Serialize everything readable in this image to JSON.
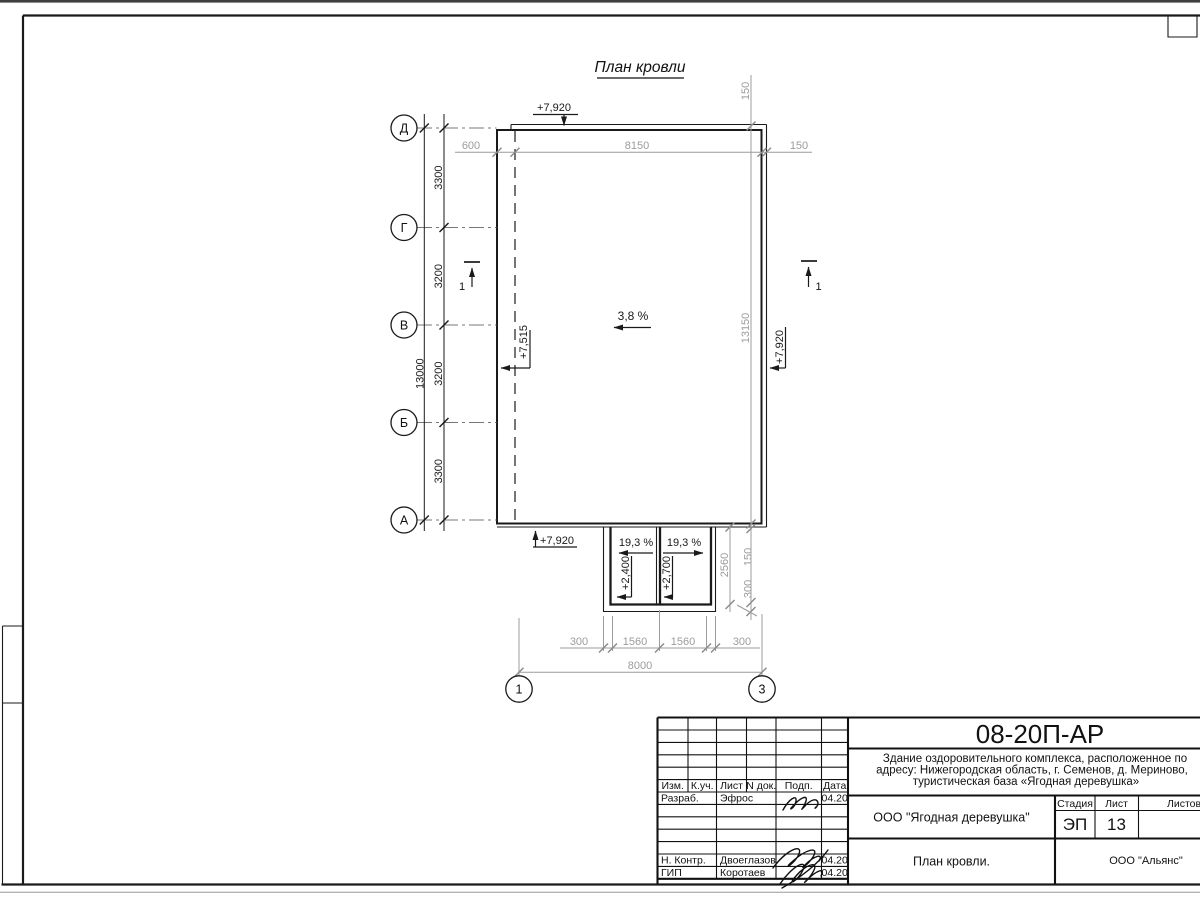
{
  "sheet": {
    "title": "План кровли"
  },
  "axes": {
    "rows": [
      "Д",
      "Г",
      "В",
      "Б",
      "А"
    ],
    "cols": [
      "1",
      "3"
    ]
  },
  "dims": {
    "top": [
      "600",
      "8150",
      "150"
    ],
    "left_segments": [
      "3300",
      "3200",
      "3200",
      "3300"
    ],
    "left_total": "13000",
    "right_top": "150",
    "right_total": "13150",
    "canopy_height": "2560",
    "canopy_right_150": "150",
    "canopy_right_300": "300",
    "bottom": [
      "300",
      "1560",
      "1560",
      "300"
    ],
    "bottom_total": "8000"
  },
  "marks": {
    "elev_top": "+7,920",
    "elev_left": "+7,515",
    "elev_right": "+7,920",
    "elev_bottom": "+7,920",
    "canopy_elev_left": "+2,400",
    "canopy_elev_right": "+2,700",
    "slope_main": "3,8 %",
    "canopy_slope_left": "19,3 %",
    "canopy_slope_right": "19,3 %",
    "section_left": "1",
    "section_right": "1"
  },
  "titleblock": {
    "doc_number": "08-20П-АР",
    "project_line1": "Здание оздоровительного комплекса, расположенное по",
    "project_line2": "адресу: Нижегородская область, г. Семенов, д. Мериново,",
    "project_line3": "туристическая база «Ягодная деревушка»",
    "header_cols": [
      "Изм.",
      "К.уч.",
      "Лист",
      "N док.",
      "Подп.",
      "Дата"
    ],
    "rows": [
      {
        "role": "Разраб.",
        "name": "Эфрос",
        "date": "04.20"
      },
      {
        "role": "Н. Контр.",
        "name": "Двоеглазов",
        "date": "04.20"
      },
      {
        "role": "ГИП",
        "name": "Коротаев",
        "date": "04.20"
      }
    ],
    "client": "ООО \"Ягодная деревушка\"",
    "stage_label": "Стадия",
    "sheet_label": "Лист",
    "sheets_label": "Листов",
    "stage": "ЭП",
    "sheet_number": "13",
    "drawing_name": "План кровли.",
    "company": "ООО \"Альянс\""
  },
  "colors": {
    "line": "#1a1a1a",
    "dim": "#9c9c9c"
  }
}
